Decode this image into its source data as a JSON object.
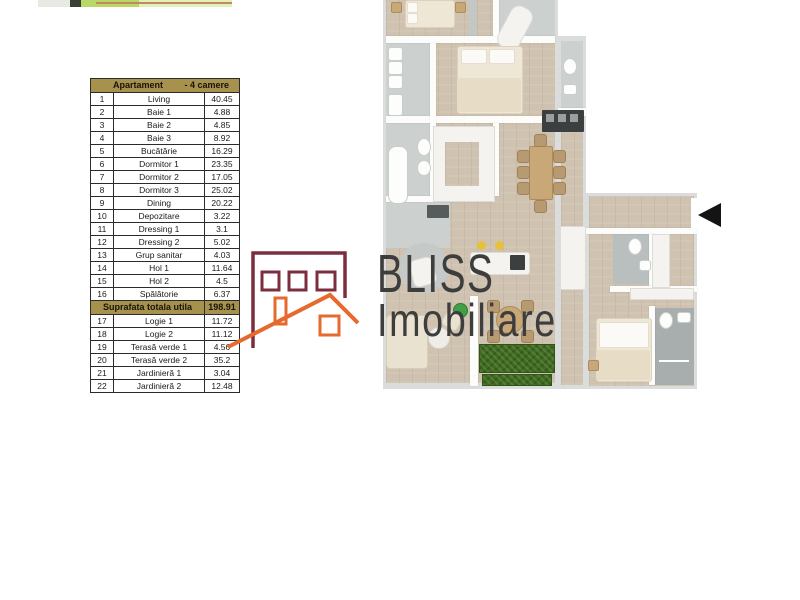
{
  "area_table": {
    "header": {
      "left": "Apartament",
      "right": "- 4 camere"
    },
    "rows": [
      {
        "num": "1",
        "name": "Living",
        "value": "40.45"
      },
      {
        "num": "2",
        "name": "Baie 1",
        "value": "4.88"
      },
      {
        "num": "3",
        "name": "Baie 2",
        "value": "4.85"
      },
      {
        "num": "4",
        "name": "Baie 3",
        "value": "8.92"
      },
      {
        "num": "5",
        "name": "Bucătărie",
        "value": "16.29"
      },
      {
        "num": "6",
        "name": "Dormitor 1",
        "value": "23.35"
      },
      {
        "num": "7",
        "name": "Dormitor 2",
        "value": "17.05"
      },
      {
        "num": "8",
        "name": "Dormitor 3",
        "value": "25.02"
      },
      {
        "num": "9",
        "name": "Dining",
        "value": "20.22"
      },
      {
        "num": "10",
        "name": "Depozitare",
        "value": "3.22"
      },
      {
        "num": "11",
        "name": "Dressing 1",
        "value": "3.1"
      },
      {
        "num": "12",
        "name": "Dressing 2",
        "value": "5.02"
      },
      {
        "num": "13",
        "name": "Grup sanitar",
        "value": "4.03"
      },
      {
        "num": "14",
        "name": "Hol 1",
        "value": "11.64"
      },
      {
        "num": "15",
        "name": "Hol 2",
        "value": "4.5"
      },
      {
        "num": "16",
        "name": "Spălătorie",
        "value": "6.37"
      }
    ],
    "total": {
      "label": "Suprafata totala utila",
      "value": "198.91"
    },
    "rows_below_total": [
      {
        "num": "17",
        "name": "Logie 1",
        "value": "11.72"
      },
      {
        "num": "18",
        "name": "Logie 2",
        "value": "11.12"
      },
      {
        "num": "19",
        "name": "Terasă verde 1",
        "value": "4.56"
      },
      {
        "num": "20",
        "name": "Terasă verde 2",
        "value": "35.2"
      },
      {
        "num": "21",
        "name": "Jardinieră 1",
        "value": "3.04"
      },
      {
        "num": "22",
        "name": "Jardinieră 2",
        "value": "12.48"
      }
    ],
    "colors": {
      "header_bg": "#a6914d",
      "border": "#2b2b2b"
    }
  },
  "logo": {
    "brand": "BLISS",
    "brand_sub": "Imobiliare",
    "colors": {
      "maroon": "#7b2e3e",
      "orange": "#e6692e",
      "text": "#3d3d3d"
    }
  },
  "floor_plan": {
    "type": "3d-top-view apartment render",
    "entrance_arrow_direction": "left",
    "colors": {
      "wood_floor": "#cfc2b0",
      "tile_gray": "#ccd0cf",
      "wall": "#fcfcfb",
      "outer_wall": "#dadddc",
      "grass_green": "#3e6b1e",
      "stool_yellow": "#e6c13c"
    }
  }
}
